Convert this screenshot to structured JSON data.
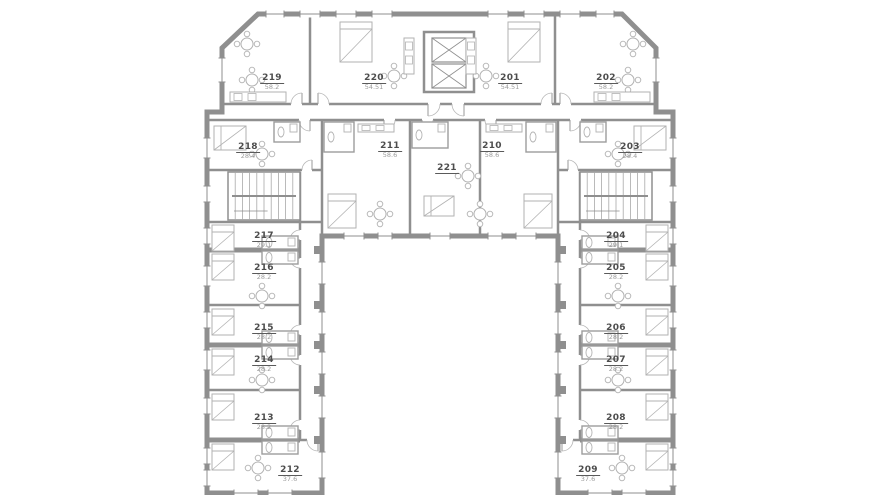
{
  "plan_title": "Floor plan level 2",
  "rooms": {
    "r201": {
      "number": "201",
      "area": "54.51"
    },
    "r202": {
      "number": "202",
      "area": "58.2"
    },
    "r203": {
      "number": "203",
      "area": "28.4"
    },
    "r204": {
      "number": "204",
      "area": "29.1"
    },
    "r205": {
      "number": "205",
      "area": "28.2"
    },
    "r206": {
      "number": "206",
      "area": "28.2"
    },
    "r207": {
      "number": "207",
      "area": "28.2"
    },
    "r208": {
      "number": "208",
      "area": "28.2"
    },
    "r209": {
      "number": "209",
      "area": "37.6"
    },
    "r210": {
      "number": "210",
      "area": "58.6"
    },
    "r211": {
      "number": "211",
      "area": "58.6"
    },
    "r212": {
      "number": "212",
      "area": "37.6"
    },
    "r213": {
      "number": "213",
      "area": "28.2"
    },
    "r214": {
      "number": "214",
      "area": "28.2"
    },
    "r215": {
      "number": "215",
      "area": "28.2"
    },
    "r216": {
      "number": "216",
      "area": "28.2"
    },
    "r217": {
      "number": "217",
      "area": "29.1"
    },
    "r218": {
      "number": "218",
      "area": "28.4"
    },
    "r219": {
      "number": "219",
      "area": "58.2"
    },
    "r220": {
      "number": "220",
      "area": "54.51"
    },
    "r221": {
      "number": "221",
      "area": ""
    }
  },
  "colors": {
    "wall": "#8f8f8f",
    "wall_core": "#9c9c9c",
    "furniture": "#b2b2b2",
    "room_number_text": "#4d4d4d",
    "area_text": "#9b9b9b",
    "background": "#ffffff"
  }
}
